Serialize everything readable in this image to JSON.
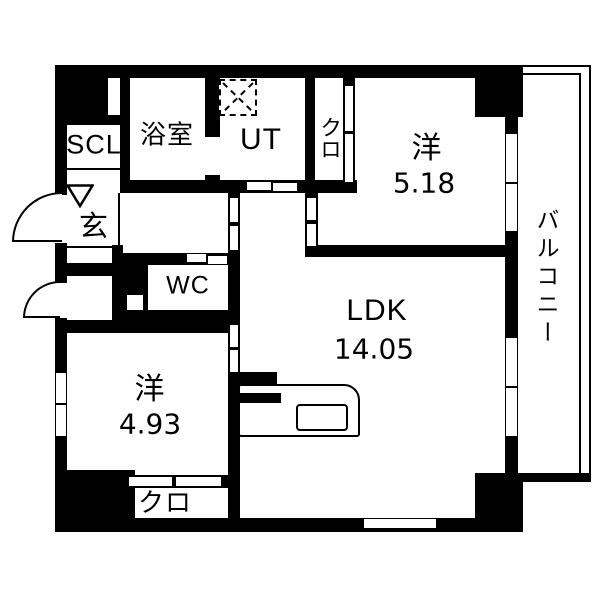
{
  "plan": {
    "rooms": {
      "bath": {
        "label": "浴室"
      },
      "utility": {
        "label": "UT"
      },
      "closet_upper": {
        "label": "クロ"
      },
      "western1": {
        "label": "洋",
        "size": "5.18"
      },
      "balcony": {
        "label": "バルコニー"
      },
      "shoe_closet": {
        "label": "SCL"
      },
      "entrance": {
        "label": "玄"
      },
      "toilet": {
        "label": "WC"
      },
      "ldk": {
        "label": "LDK",
        "size": "14.05"
      },
      "western2": {
        "label": "洋",
        "size": "4.93"
      },
      "closet_lower": {
        "label": "クロ"
      }
    },
    "colors": {
      "wall": "#000000",
      "floor": "#ffffff"
    }
  }
}
